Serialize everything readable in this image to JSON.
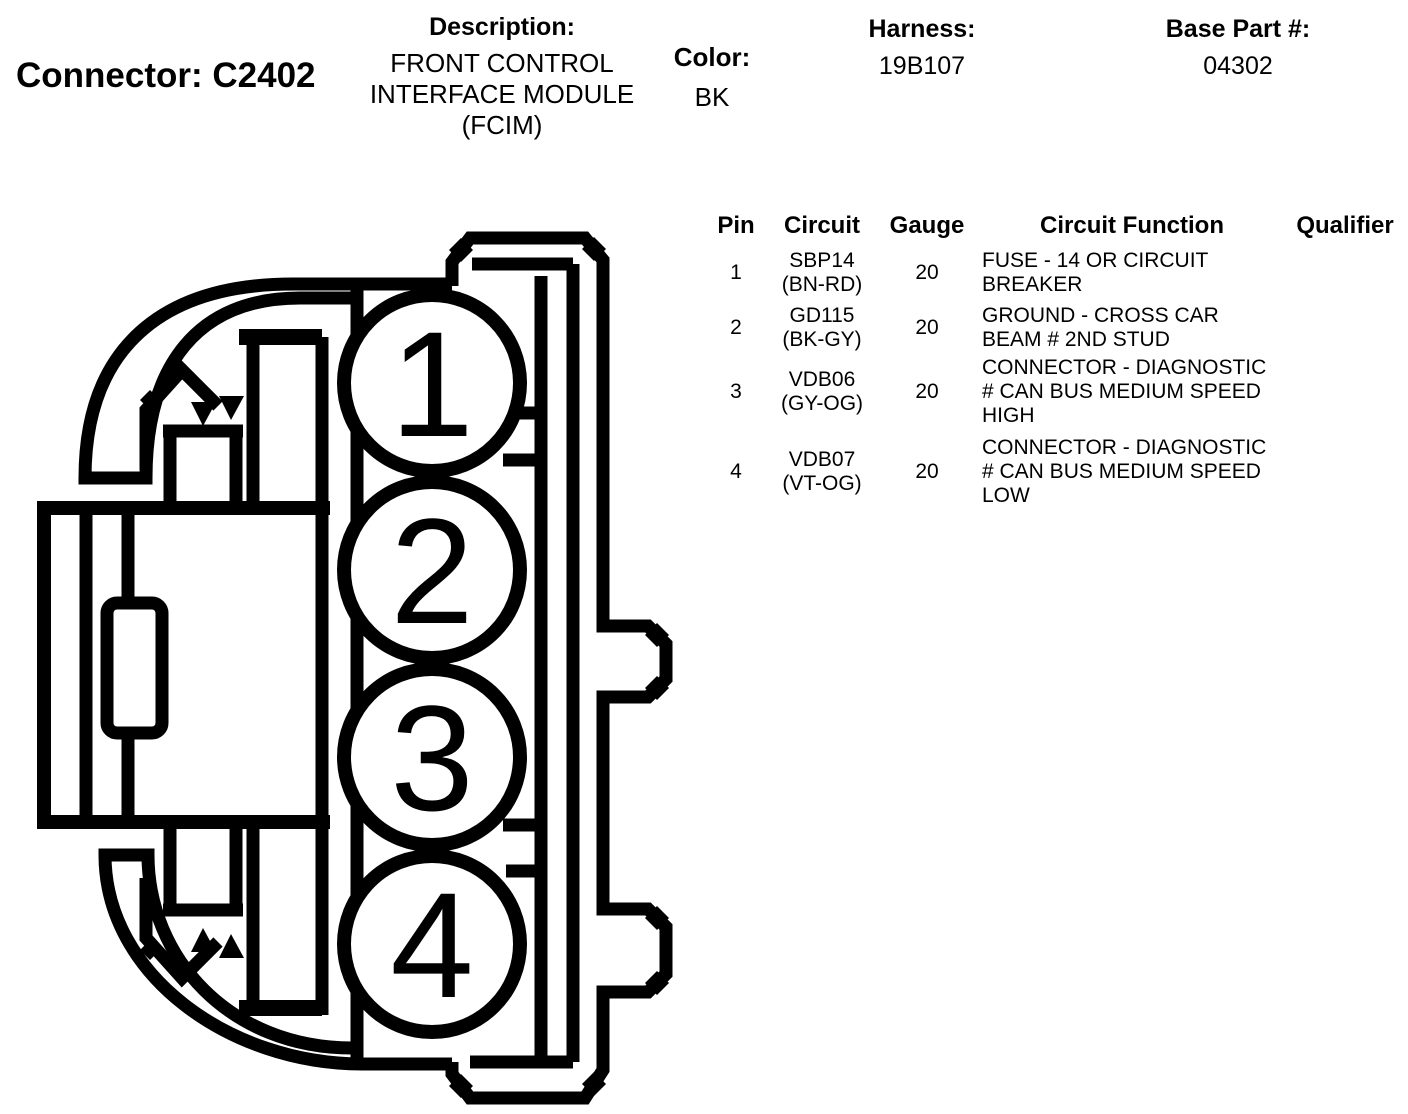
{
  "header": {
    "connector_title": "Connector: C2402",
    "description": {
      "label": "Description:",
      "lines": [
        "FRONT CONTROL",
        "INTERFACE MODULE",
        "(FCIM)"
      ]
    },
    "color": {
      "label": "Color:",
      "value": "BK"
    },
    "harness": {
      "label": "Harness:",
      "value": "19B107"
    },
    "base_part": {
      "label": "Base Part #:",
      "value": "04302"
    }
  },
  "pin_table": {
    "headers": {
      "pin": "Pin",
      "circuit": "Circuit",
      "gauge": "Gauge",
      "function": "Circuit Function",
      "qualifier": "Qualifier"
    },
    "rows": [
      {
        "pin": "1",
        "circuit": "SBP14",
        "circuit_color": "(BN-RD)",
        "gauge": "20",
        "function_lines": [
          "FUSE - 14 OR CIRCUIT",
          "BREAKER"
        ],
        "qualifier": ""
      },
      {
        "pin": "2",
        "circuit": "GD115",
        "circuit_color": "(BK-GY)",
        "gauge": "20",
        "function_lines": [
          "GROUND - CROSS CAR",
          "BEAM # 2ND STUD"
        ],
        "qualifier": ""
      },
      {
        "pin": "3",
        "circuit": "VDB06",
        "circuit_color": "(GY-OG)",
        "gauge": "20",
        "function_lines": [
          "CONNECTOR - DIAGNOSTIC",
          "# CAN BUS MEDIUM SPEED",
          "HIGH"
        ],
        "qualifier": ""
      },
      {
        "pin": "4",
        "circuit": "VDB07",
        "circuit_color": "(VT-OG)",
        "gauge": "20",
        "function_lines": [
          "CONNECTOR - DIAGNOSTIC",
          "# CAN BUS MEDIUM SPEED",
          "LOW"
        ],
        "qualifier": ""
      }
    ]
  },
  "diagram": {
    "cavity_labels": [
      "1",
      "2",
      "3",
      "4"
    ],
    "line_color": "#000000",
    "fill_color": "#ffffff"
  }
}
